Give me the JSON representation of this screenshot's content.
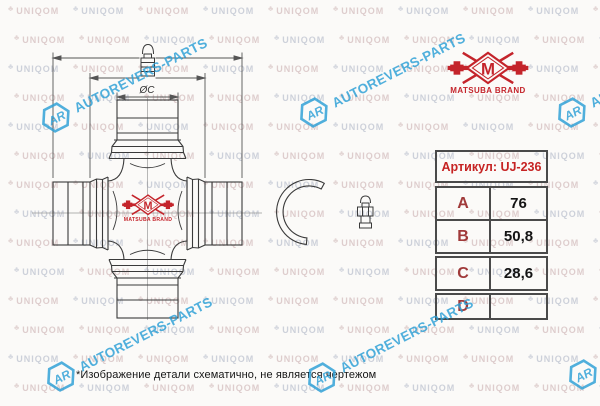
{
  "brand": {
    "monogram": "M",
    "name": "MATSUBA BRAND",
    "color": "#c4242b"
  },
  "table": {
    "header": "Артикул: UJ-236",
    "rows": [
      {
        "label": "A",
        "value": "76"
      },
      {
        "label": "B",
        "value": "50,8"
      },
      {
        "label": "C",
        "value": "28,6"
      },
      {
        "label": "D",
        "value": ""
      }
    ]
  },
  "drawing": {
    "dim_c_label": "ØC"
  },
  "note": "*Изображение детали схематично, не является чертежом",
  "watermarks": {
    "uniqom": {
      "text": "UNIQOM",
      "glyph": "♣",
      "color_warm": "#d9c6c6",
      "color_cool": "#c6cad5",
      "cols": 10,
      "rows": 14,
      "dx": 65,
      "dy": 29,
      "x0": 8,
      "y0": 6
    },
    "autorevers": {
      "logo": "AR",
      "text": "AUTOREVERS-PARTS",
      "color": "#2b9fd6",
      "positions": [
        {
          "x": 55,
          "y": 118
        },
        {
          "x": 313,
          "y": 113
        },
        {
          "x": 571,
          "y": 113
        },
        {
          "x": 60,
          "y": 377
        },
        {
          "x": 321,
          "y": 378
        },
        {
          "x": 582,
          "y": 375
        }
      ]
    }
  }
}
